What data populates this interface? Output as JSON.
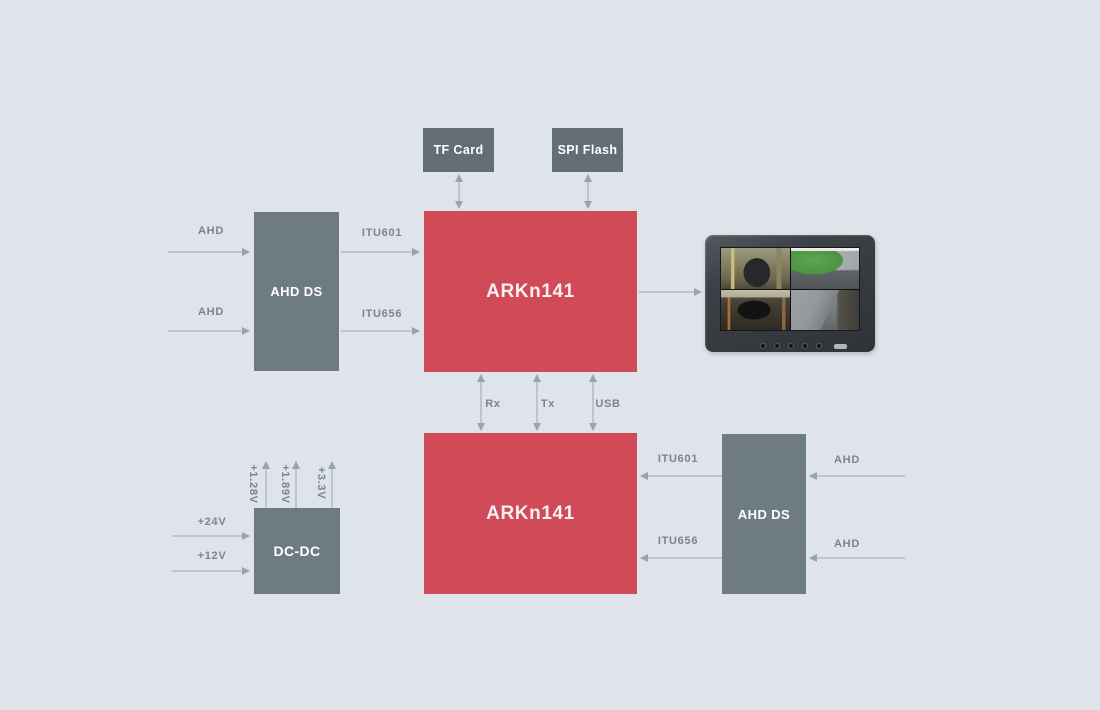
{
  "colors": {
    "background": "#dee4ea",
    "accent_red": "#d04b57",
    "block_gray": "#6f7b83",
    "storage_gray": "#626d76",
    "label_gray": "#7a8591",
    "arrow_gray": "#aab3bb"
  },
  "blocks": {
    "tf_card": "TF Card",
    "spi_flash": "SPI Flash",
    "soc_top": "ARKn141",
    "soc_bottom": "ARKn141",
    "ahd_ds_left": "AHD DS",
    "ahd_ds_right": "AHD DS",
    "dc_dc": "DC-DC"
  },
  "signals": {
    "ahd_top_1": "AHD",
    "ahd_top_2": "AHD",
    "itu601_top": "ITU601",
    "itu656_top": "ITU656",
    "rx": "Rx",
    "tx": "Tx",
    "usb": "USB",
    "itu601_bottom": "ITU601",
    "itu656_bottom": "ITU656",
    "ahd_bottom_1": "AHD",
    "ahd_bottom_2": "AHD",
    "power_in_24v": "+24V",
    "power_in_12v": "+12V",
    "power_out_1_28v": "+1.28V",
    "power_out_1_89v": "+1.89V",
    "power_out_3_3v": "+3.3V"
  },
  "monitor": {
    "icon": "quad-view-cctv-monitor"
  }
}
